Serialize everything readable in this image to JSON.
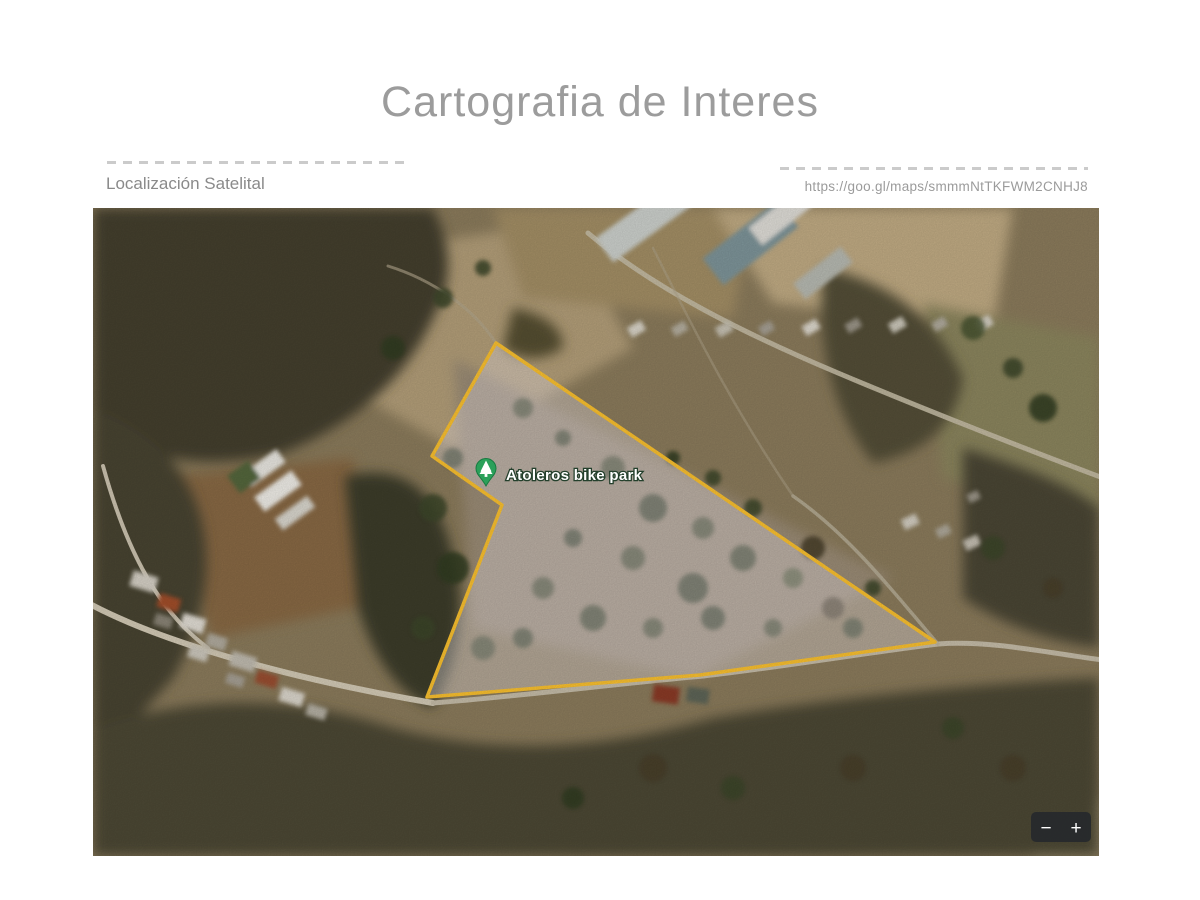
{
  "slide": {
    "title": "Cartografia de Interes",
    "left_caption": "Localización Satelital",
    "right_caption": "https://goo.gl/maps/smmmNtTKFWM2CNHJ8"
  },
  "map": {
    "poi_label": "Atoleros bike park",
    "zoom_out": "−",
    "zoom_in": "+",
    "overlay_color": "#fdc330",
    "overlay_fill": "rgba(238,229,234,0.40)",
    "pin_color": "#2ba05a",
    "control_bg": "#26292c"
  }
}
